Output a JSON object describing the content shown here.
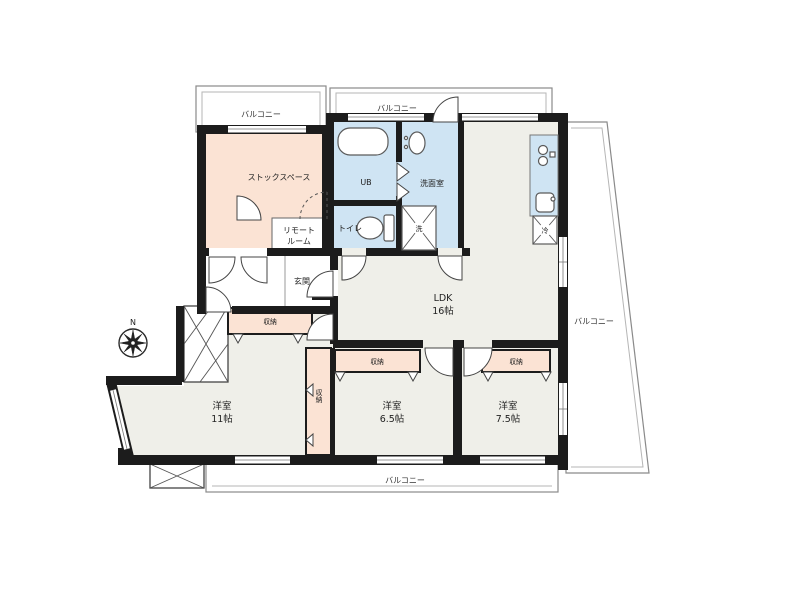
{
  "floorplan": {
    "balconies": {
      "top_left": "バルコニー",
      "top": "バルコニー",
      "right": "バルコニー",
      "bottom": "バルコニー"
    },
    "rooms": {
      "stock_space": "ストックスペース",
      "remote_room_l1": "リモート",
      "remote_room_l2": "ルーム",
      "unit_bath": "UB",
      "washroom": "洗面室",
      "toilet": "トイレ",
      "entrance": "玄関",
      "ldk_l1": "LDK",
      "ldk_l2": "16帖",
      "bedroom_west_l1": "洋室",
      "bedroom_west_l2": "11帖",
      "bedroom_center_l1": "洋室",
      "bedroom_center_l2": "6.5帖",
      "bedroom_east_l1": "洋室",
      "bedroom_east_l2": "7.5帖"
    },
    "closets": {
      "bedroom_west": "収納",
      "bedroom_west_side": "収納",
      "bedroom_center": "収納",
      "bedroom_east": "収納"
    },
    "appliances": {
      "laundry": "洗",
      "refrigerator": "冷"
    },
    "compass": {
      "north": "N"
    },
    "colors": {
      "wall": "#1c1c1c",
      "room_peach": "#fbe3d4",
      "room_blue": "#cfe4f3",
      "room_floor": "#efefe9",
      "outline": "#8a8a8a"
    }
  }
}
